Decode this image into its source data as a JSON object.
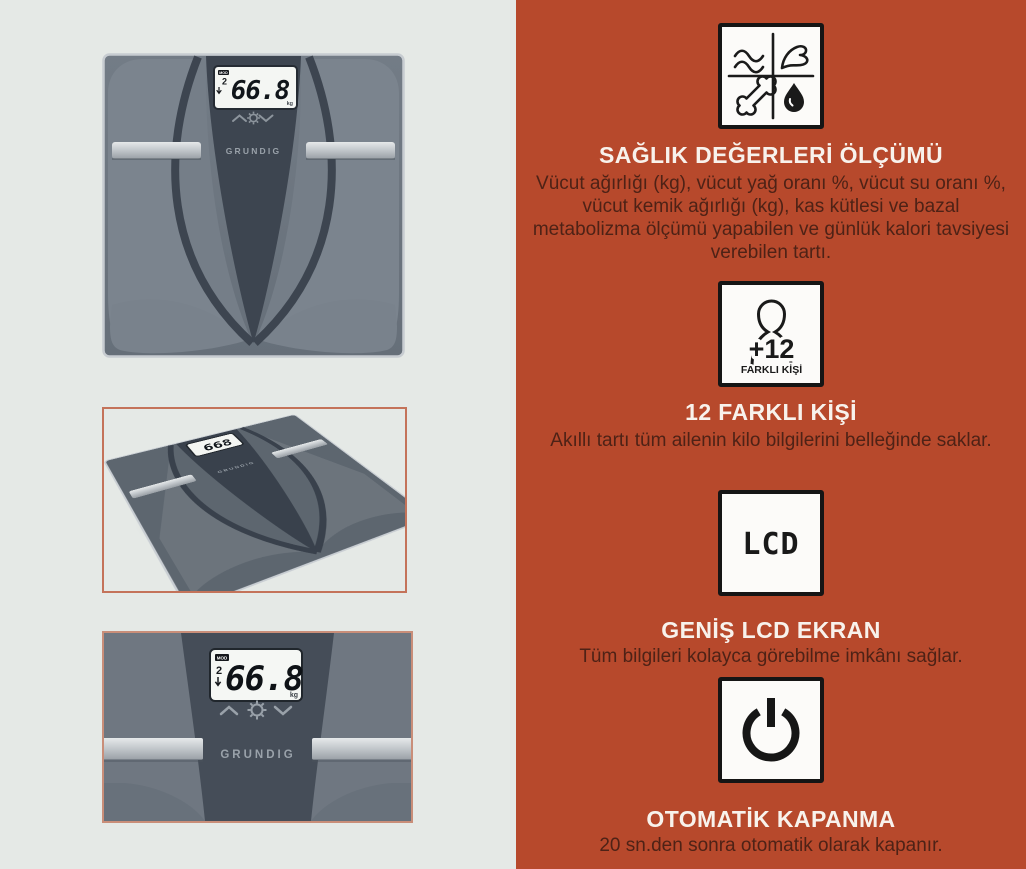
{
  "panel_left": {
    "bg": "#e5e9e6",
    "frame_mid_border": "#c4735a",
    "frame_bottom_border": "#c98e79"
  },
  "panel_right": {
    "bg": "#b7492c",
    "heading_color": "#f8f2ec",
    "body_color": "#4e2216"
  },
  "product": {
    "brand": "GRUNDIG",
    "display": {
      "value": "66.8",
      "value_compact": "668",
      "unit": "kg",
      "mode_label": "MOD",
      "user_number": "2"
    }
  },
  "features": [
    {
      "icon": "health-metrics-icon",
      "title": "SAĞLIK DEĞERLERİ ÖLÇÜMÜ",
      "description": "Vücut ağırlığı (kg), vücut yağ oranı %, vücut su oranı %, vücut kemik ağırlığı (kg), kas kütlesi ve bazal metabolizma ölçümü yapabilen ve günlük kalori tavsiyesi verebilen tartı."
    },
    {
      "icon": "multi-user-icon",
      "badge": "+12",
      "badge_label": "FARKLI KİŞİ",
      "title": "12 FARKLI KİŞİ",
      "description": "Akıllı tartı tüm ailenin kilo bilgilerini belleğinde saklar."
    },
    {
      "icon": "lcd-icon",
      "glyph": "LCD",
      "title": "GENİŞ LCD EKRAN",
      "description": "Tüm bilgileri kolayca görebilme imkânı sağlar."
    },
    {
      "icon": "power-icon",
      "title": "OTOMATİK KAPANMA",
      "description": "20 sn.den sonra otomatik olarak kapanır."
    }
  ]
}
